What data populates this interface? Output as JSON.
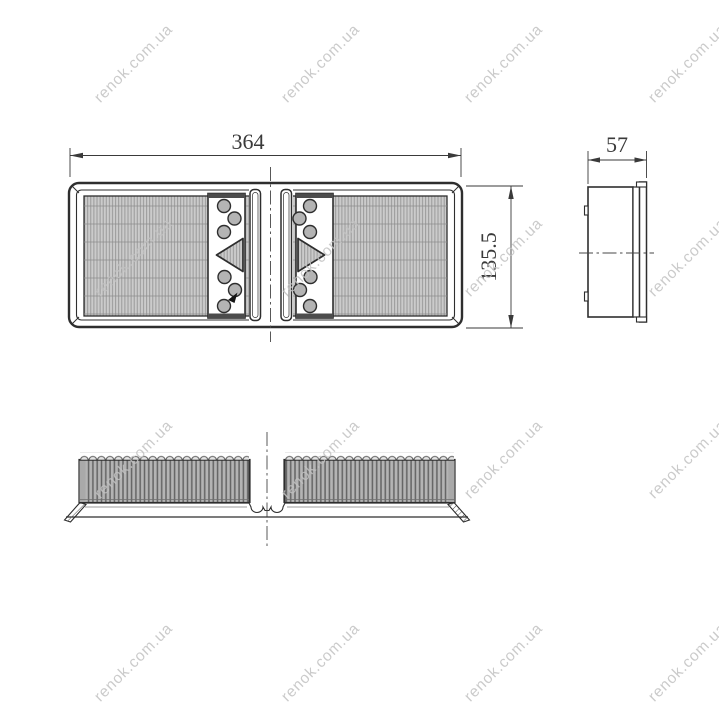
{
  "drawing": {
    "dimensions": {
      "width": "364",
      "depth": "57",
      "height": "135.5"
    },
    "watermark": {
      "text": "renok.com.ua"
    },
    "colors": {
      "line": "#2e2e2e",
      "media_fill": "#cbcbcb",
      "watermark": "#c2c2c2"
    }
  }
}
